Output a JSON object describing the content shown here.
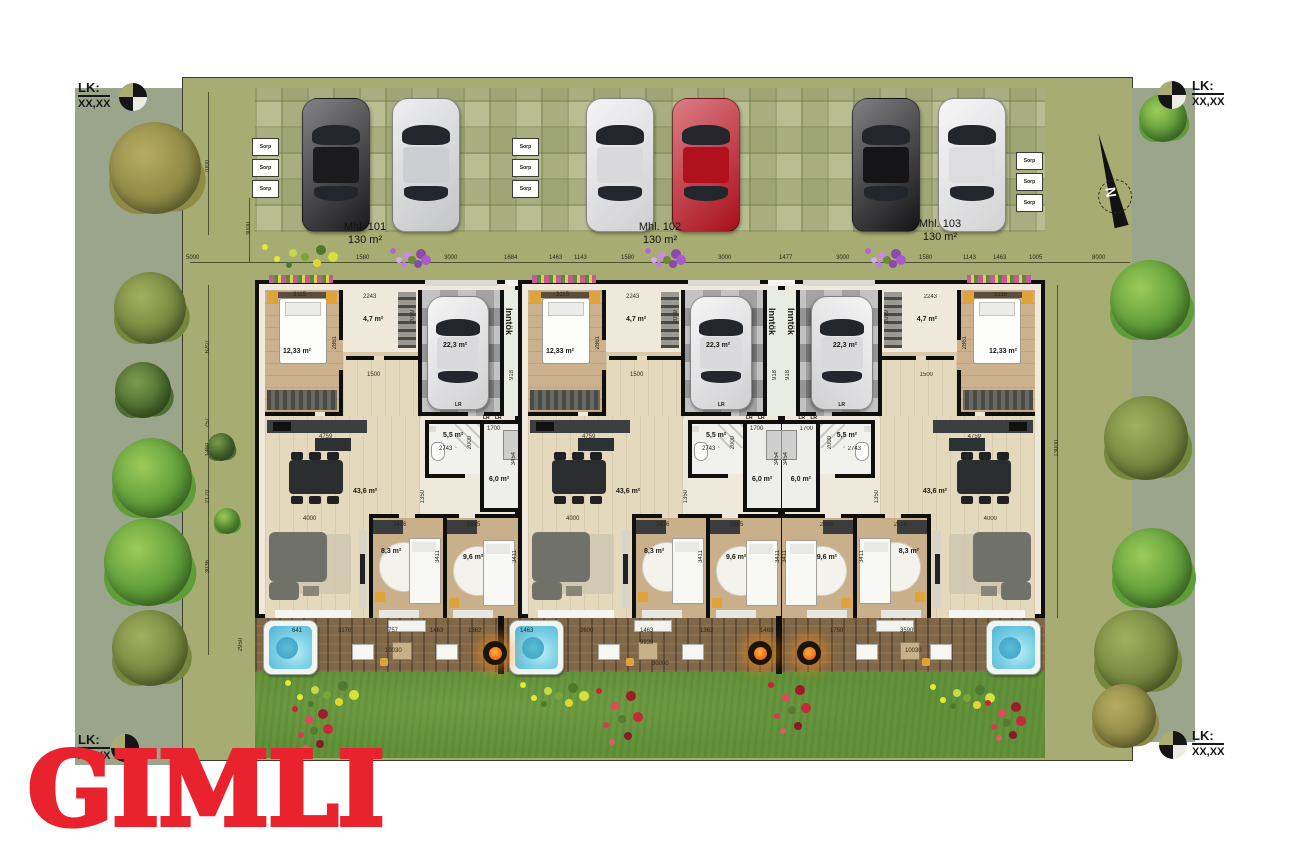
{
  "logo": {
    "text": "GIMLI",
    "color": "#e8232e"
  },
  "north_arrow": {
    "label": "N"
  },
  "corner_markers": [
    {
      "position": "top-left",
      "label": "LK:",
      "value": "XX,XX"
    },
    {
      "position": "top-right",
      "label": "LK:",
      "value": "XX,XX"
    },
    {
      "position": "bottom-left",
      "label": "LK:",
      "value": "XX,XX"
    },
    {
      "position": "bottom-right",
      "label": "LK:",
      "value": "XX,XX"
    }
  ],
  "parking": {
    "bin_label": "Sorp",
    "bin_groups": [
      {
        "bins": 3
      },
      {
        "bins": 3
      },
      {
        "bins": 3
      }
    ],
    "stalls": [
      {
        "id": "Mhl. 101",
        "area": "130 m²"
      },
      {
        "id": "Mhl. 102",
        "area": "130 m²"
      },
      {
        "id": "Mhl. 103",
        "area": "130 m²"
      }
    ],
    "cars": [
      {
        "color_name": "black",
        "hex": "#1d1d20"
      },
      {
        "color_name": "silver",
        "hex": "#dfe0e3"
      },
      {
        "color_name": "white",
        "hex": "#ececef"
      },
      {
        "color_name": "red",
        "hex": "#c01220"
      },
      {
        "color_name": "black",
        "hex": "#17171a"
      },
      {
        "color_name": "white",
        "hex": "#f0f0f2"
      }
    ]
  },
  "units": {
    "count": 3,
    "entrance_label": "Inntök",
    "closet_label": "LR",
    "garage_car_color": "#ededef",
    "rooms": {
      "bedroom_main": "12,33 m²",
      "entry": "4,7 m²",
      "garage": "22,3 m²",
      "bath": "5,5 m²",
      "laundry": "6,0 m²",
      "kitchen_living": "43,6 m²",
      "bedroom_2": "8,3 m²",
      "bedroom_3": "9,6 m²"
    },
    "interior_dims": {
      "bedroom_w": "3115",
      "bedroom_d": "2861",
      "entry_w": "2243",
      "entry_d": "2099",
      "hall_w": "1500",
      "walkway_w": "918",
      "kitchen_w": "4759",
      "living_w": "4000",
      "bath_w": "2743",
      "bath_d": "2000",
      "laundry_w": "1700",
      "laundry_d": "3454",
      "corridor": "1350",
      "bedroom2_w": "2416",
      "bedroom2_d": "3411",
      "bedroom3_w": "2835",
      "bedroom3_d": "3411"
    }
  },
  "site_dimensions": {
    "top_chain": [
      "5000",
      "1580",
      "3000",
      "1684",
      "1463",
      "1143",
      "1580",
      "3000",
      "1477",
      "3000",
      "1580",
      "1143",
      "1463",
      "1005",
      "8000"
    ],
    "left_chain": [
      "7000",
      "3000",
      "6207",
      "757",
      "1360",
      "2170",
      "3036",
      "2950"
    ],
    "right_chain": [
      "13000"
    ],
    "deck_chain": [
      "641",
      "3170",
      "757",
      "1463",
      "1362",
      "1463",
      "2600",
      "1463",
      "1362",
      "1463",
      "1750",
      "3590"
    ],
    "deck_totals": [
      "10030",
      "9939",
      "10030",
      "30000"
    ]
  },
  "colors": {
    "olive": "#a7ad72",
    "road": "#9ba58b",
    "paver": "#b9bd92",
    "deck": "#806748",
    "grass": "#61923a",
    "water": "#7fd2e6",
    "fire": "#f47216",
    "wall": "#0f0f0d",
    "wood_floor": "#e4d9bd",
    "bedroom_floor": "#cbb18d",
    "garage_floor": "#9b9b9b",
    "bath_floor": "#f1f1ee"
  }
}
